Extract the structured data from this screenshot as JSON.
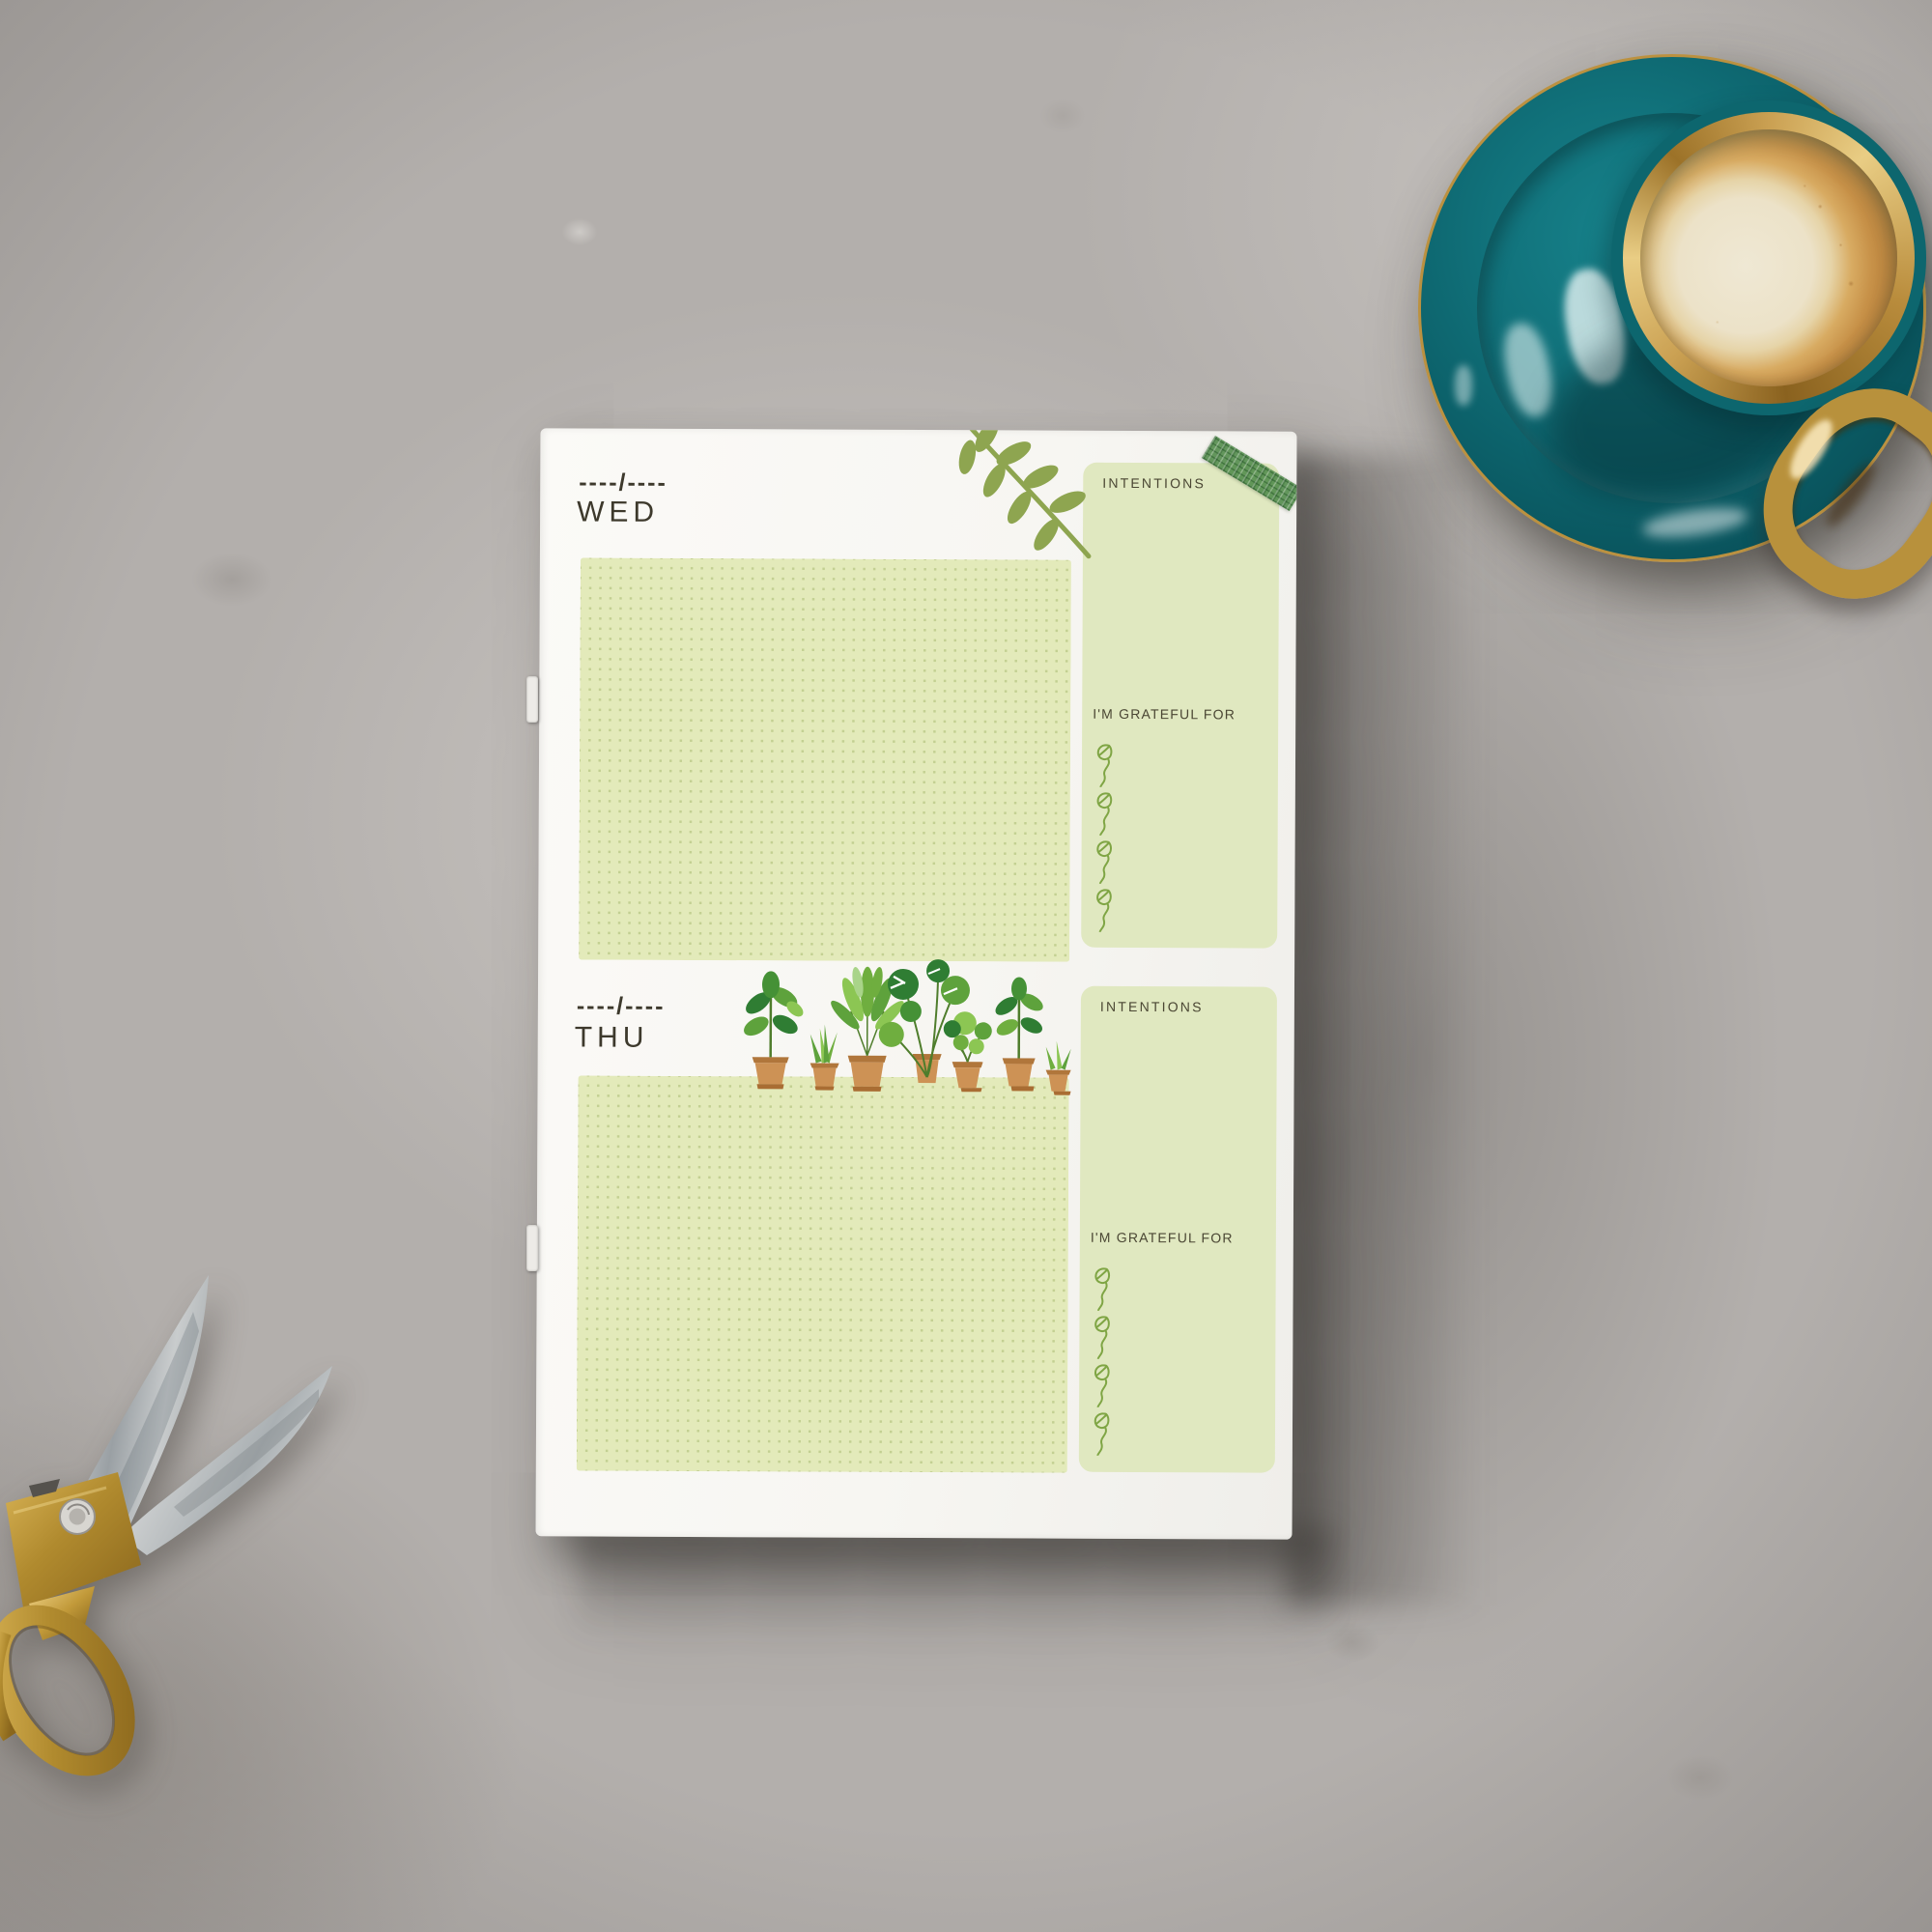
{
  "planner": {
    "days": [
      {
        "id": "wed",
        "date_placeholder": "----/----",
        "day_label": "WED",
        "intentions_label": "INTENTIONS",
        "grateful_label": "I'M GRATEFUL FOR",
        "grateful_items": 4
      },
      {
        "id": "thu",
        "date_placeholder": "----/----",
        "day_label": "THU",
        "intentions_label": "INTENTIONS",
        "grateful_label": "I'M GRATEFUL FOR",
        "grateful_items": 4
      }
    ],
    "colors": {
      "paper": "#f7f6f2",
      "note_area": "#e3eaba",
      "note_dot": "#c3d092",
      "side_panel": "#e0e8c0",
      "text": "#3d392c",
      "leaf_branch": "#8ea550",
      "sprout": "#7fa544",
      "washi_tape": "#568e4f",
      "plant_pot": "#cd9255"
    }
  },
  "props": {
    "surface": "concrete-table",
    "coffee": {
      "saucer_color": "#0c616a",
      "rim_color": "gold",
      "drink": "latte-with-foam"
    },
    "scissors": {
      "handles": "gold",
      "blades": "steel"
    }
  }
}
